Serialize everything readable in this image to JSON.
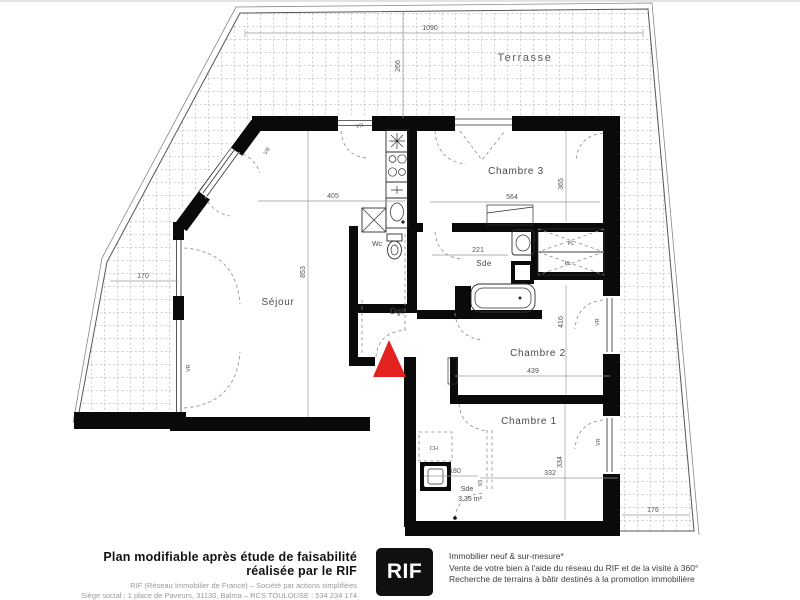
{
  "plan": {
    "labels": {
      "terrasse": "Terrasse",
      "sejour": "Séjour",
      "chambre1": "Chambre 1",
      "chambre2": "Chambre 2",
      "chambre3": "Chambre 3",
      "sde": "Sde",
      "wc": "Wc",
      "dgt": "Dgt",
      "sde2": "Sde",
      "sde2_area": "3.35 m²",
      "ch": "CH",
      "pl": "PL",
      "vr": "VR"
    },
    "dims": {
      "d1090": "1090",
      "d266": "266",
      "d170": "170",
      "d405": "405",
      "d853": "853",
      "d564": "564",
      "d365": "365",
      "d221": "221",
      "d416": "416",
      "d439": "439",
      "d334": "334",
      "d332": "332",
      "d180": "180",
      "d176": "176",
      "d93": "93"
    },
    "colors": {
      "wall": "#0a0a0a",
      "arrow_red": "#e42320",
      "tile_grid": "#c4c4c4"
    }
  },
  "footer": {
    "left_title": "Plan modifiable après étude de faisabilité réalisée par le RIF",
    "left_line1": "RIF (Réseau Immobilier de France) – Société par actions simplifiées",
    "left_line2": "Siège social : 1 place de Paveurs, 31130, Balma – RCS TOULOUSE : 534 234 174",
    "logo_text": "RIF",
    "right_line1": "Immobilier neuf & sur-mesure*",
    "right_line2": "Vente de votre bien à l'aide du réseau du RIF et de la visite à 360°",
    "right_line3": "Recherche de terrains à bâtir destinés à la promotion immobilière"
  }
}
